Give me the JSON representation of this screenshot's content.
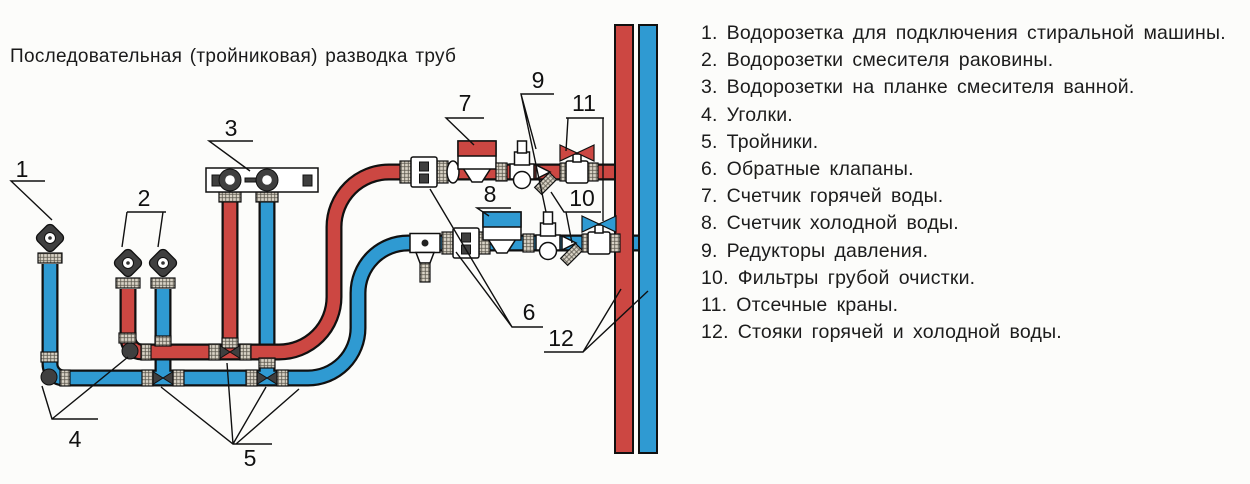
{
  "title": "Последовательная (тройниковая) разводка труб",
  "legend": {
    "items": [
      {
        "num": "1.",
        "label": "Водорозетка для подключения стиральной машины."
      },
      {
        "num": "2.",
        "label": "Водорозетки смесителя раковины."
      },
      {
        "num": "3.",
        "label": "Водорозетки на планке смесителя ванной."
      },
      {
        "num": "4.",
        "label": "Уголки."
      },
      {
        "num": "5.",
        "label": "Тройники."
      },
      {
        "num": "6.",
        "label": "Обратные клапаны."
      },
      {
        "num": "7.",
        "label": "Счетчик горячей воды."
      },
      {
        "num": "8.",
        "label": "Счетчик холодной воды."
      },
      {
        "num": "9.",
        "label": "Редукторы давления."
      },
      {
        "num": "10.",
        "label": "Фильтры грубой очистки."
      },
      {
        "num": "11.",
        "label": "Отсечные краны."
      },
      {
        "num": "12.",
        "label": "Стояки горячей и холодной воды."
      }
    ]
  },
  "diagram": {
    "callouts": [
      "1",
      "2",
      "3",
      "4",
      "5",
      "6",
      "7",
      "8",
      "9",
      "10",
      "11",
      "12"
    ],
    "colors": {
      "hot": "#cc4742",
      "cold": "#2f9ad2",
      "fitting": "#d8d2c5",
      "metal": "#3f3f3f"
    },
    "icons": [
      "water-outlet-icon",
      "mixer-plate-icon",
      "elbow-icon",
      "tee-icon",
      "check-valve-icon",
      "water-meter-icon",
      "pressure-reducer-icon",
      "strainer-filter-icon",
      "ball-valve-icon",
      "drain-valve-icon",
      "riser-pipe"
    ]
  }
}
